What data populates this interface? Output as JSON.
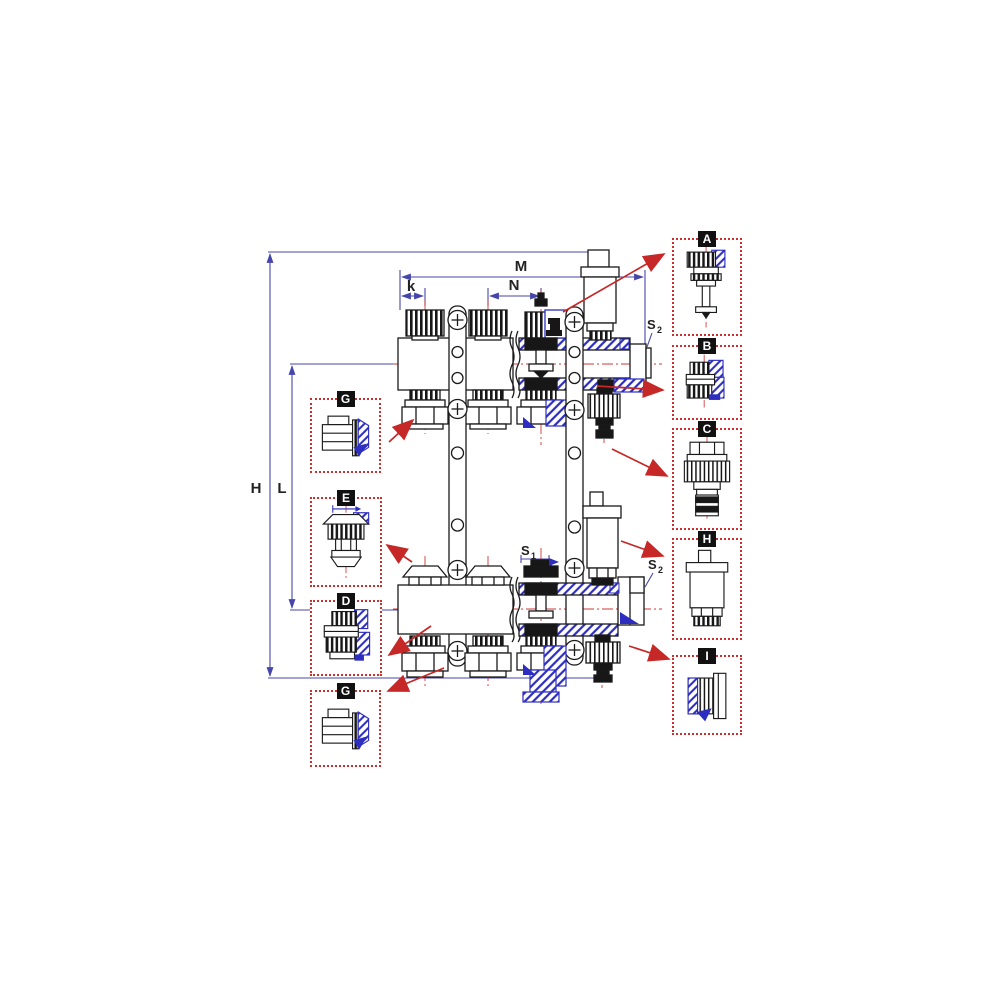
{
  "diagram": {
    "kind": "technical drawing",
    "subject": "heating manifold assembly, sectional front view with lettered detail callouts"
  },
  "dimensions": {
    "H": "H",
    "L": "L",
    "M": "M",
    "N": "N",
    "k": "k",
    "S1": {
      "base": "S",
      "sub": "1"
    },
    "S2_top": {
      "base": "S",
      "sub": "2"
    },
    "S2_bottom": {
      "base": "S",
      "sub": "2"
    }
  },
  "callouts": {
    "right": [
      {
        "label": "A"
      },
      {
        "label": "B"
      },
      {
        "label": "C"
      },
      {
        "label": "H"
      },
      {
        "label": "I"
      }
    ],
    "left": [
      {
        "label": "G"
      },
      {
        "label": "E"
      },
      {
        "label": "D"
      },
      {
        "label": "G"
      }
    ]
  },
  "colors": {
    "background": "#ffffff",
    "line": "#1a1a1a",
    "section_blue": "#2d2dc0",
    "dimension_blue": "#4646aa",
    "centerline_red": "#cf3838",
    "callout_border_red": "#cc2e2e",
    "arrow_red": "#c62828",
    "label_chip_bg": "#111111",
    "label_chip_fg": "#ffffff"
  }
}
